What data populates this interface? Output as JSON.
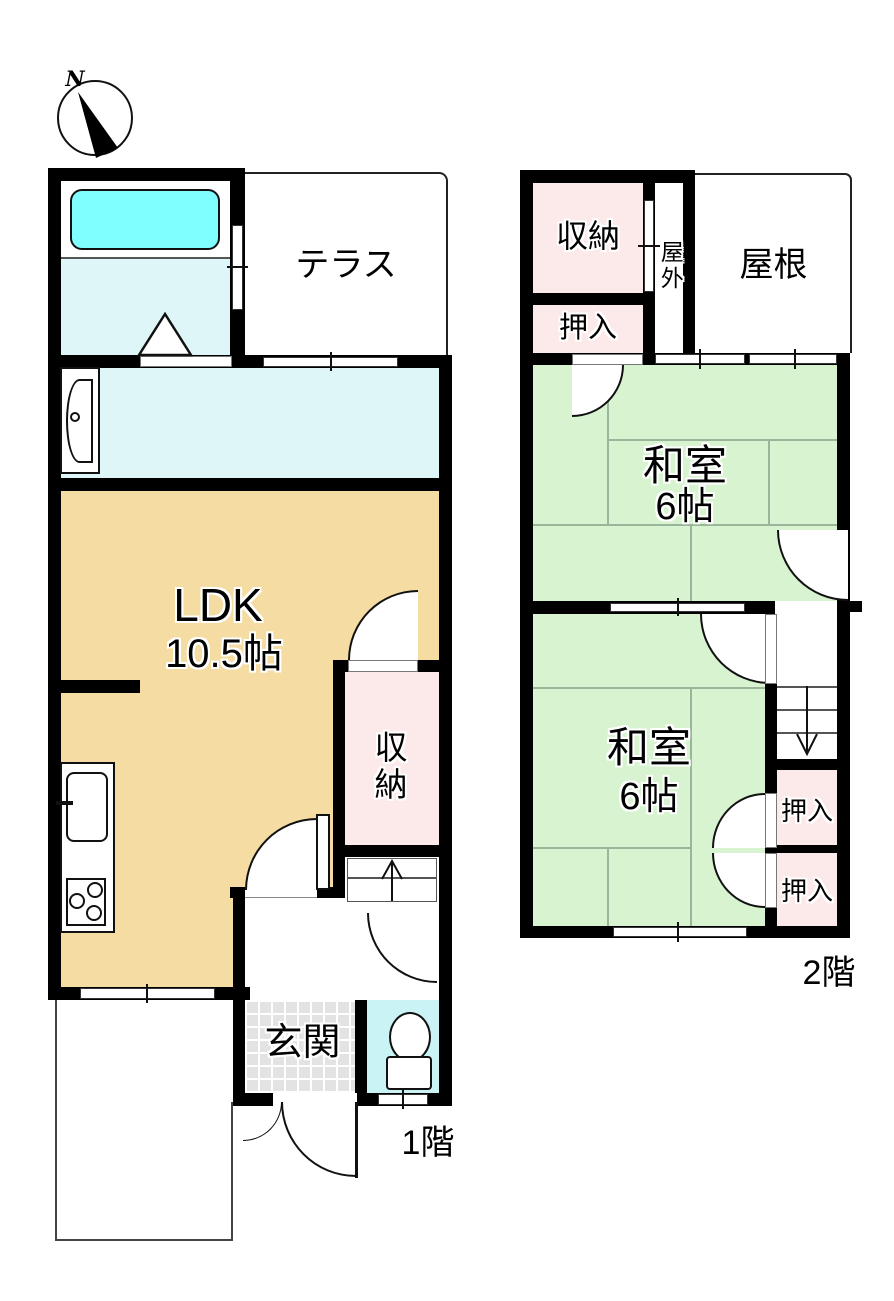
{
  "compass": {
    "north_label": "N"
  },
  "colors": {
    "wall": "#000000",
    "ldk_fill": "#F4DCA2",
    "tatami_fill": "#D8F3D0",
    "closet_fill": "#FBEAE9",
    "bath_floor_fill": "#DFF6F8",
    "bathtub_fill": "#7FFFFF",
    "toilet_floor_fill": "#C9F3F5",
    "entrance_fill": "#E3E3E3"
  },
  "floor1": {
    "floor_label": "1階",
    "terrace_label": "テラス",
    "ldk_label": "LDK",
    "ldk_size_label": "10.5帖",
    "storage_label": "収納",
    "entrance_label": "玄関"
  },
  "floor2": {
    "floor_label": "2階",
    "storage_label": "収納",
    "closet_top_label": "押入",
    "outside_label": "屋外",
    "roof_label": "屋根",
    "room1_label": "和室",
    "room1_size_label": "6帖",
    "room2_label": "和室",
    "room2_size_label": "6帖",
    "closet_a_label": "押入",
    "closet_b_label": "押入"
  }
}
